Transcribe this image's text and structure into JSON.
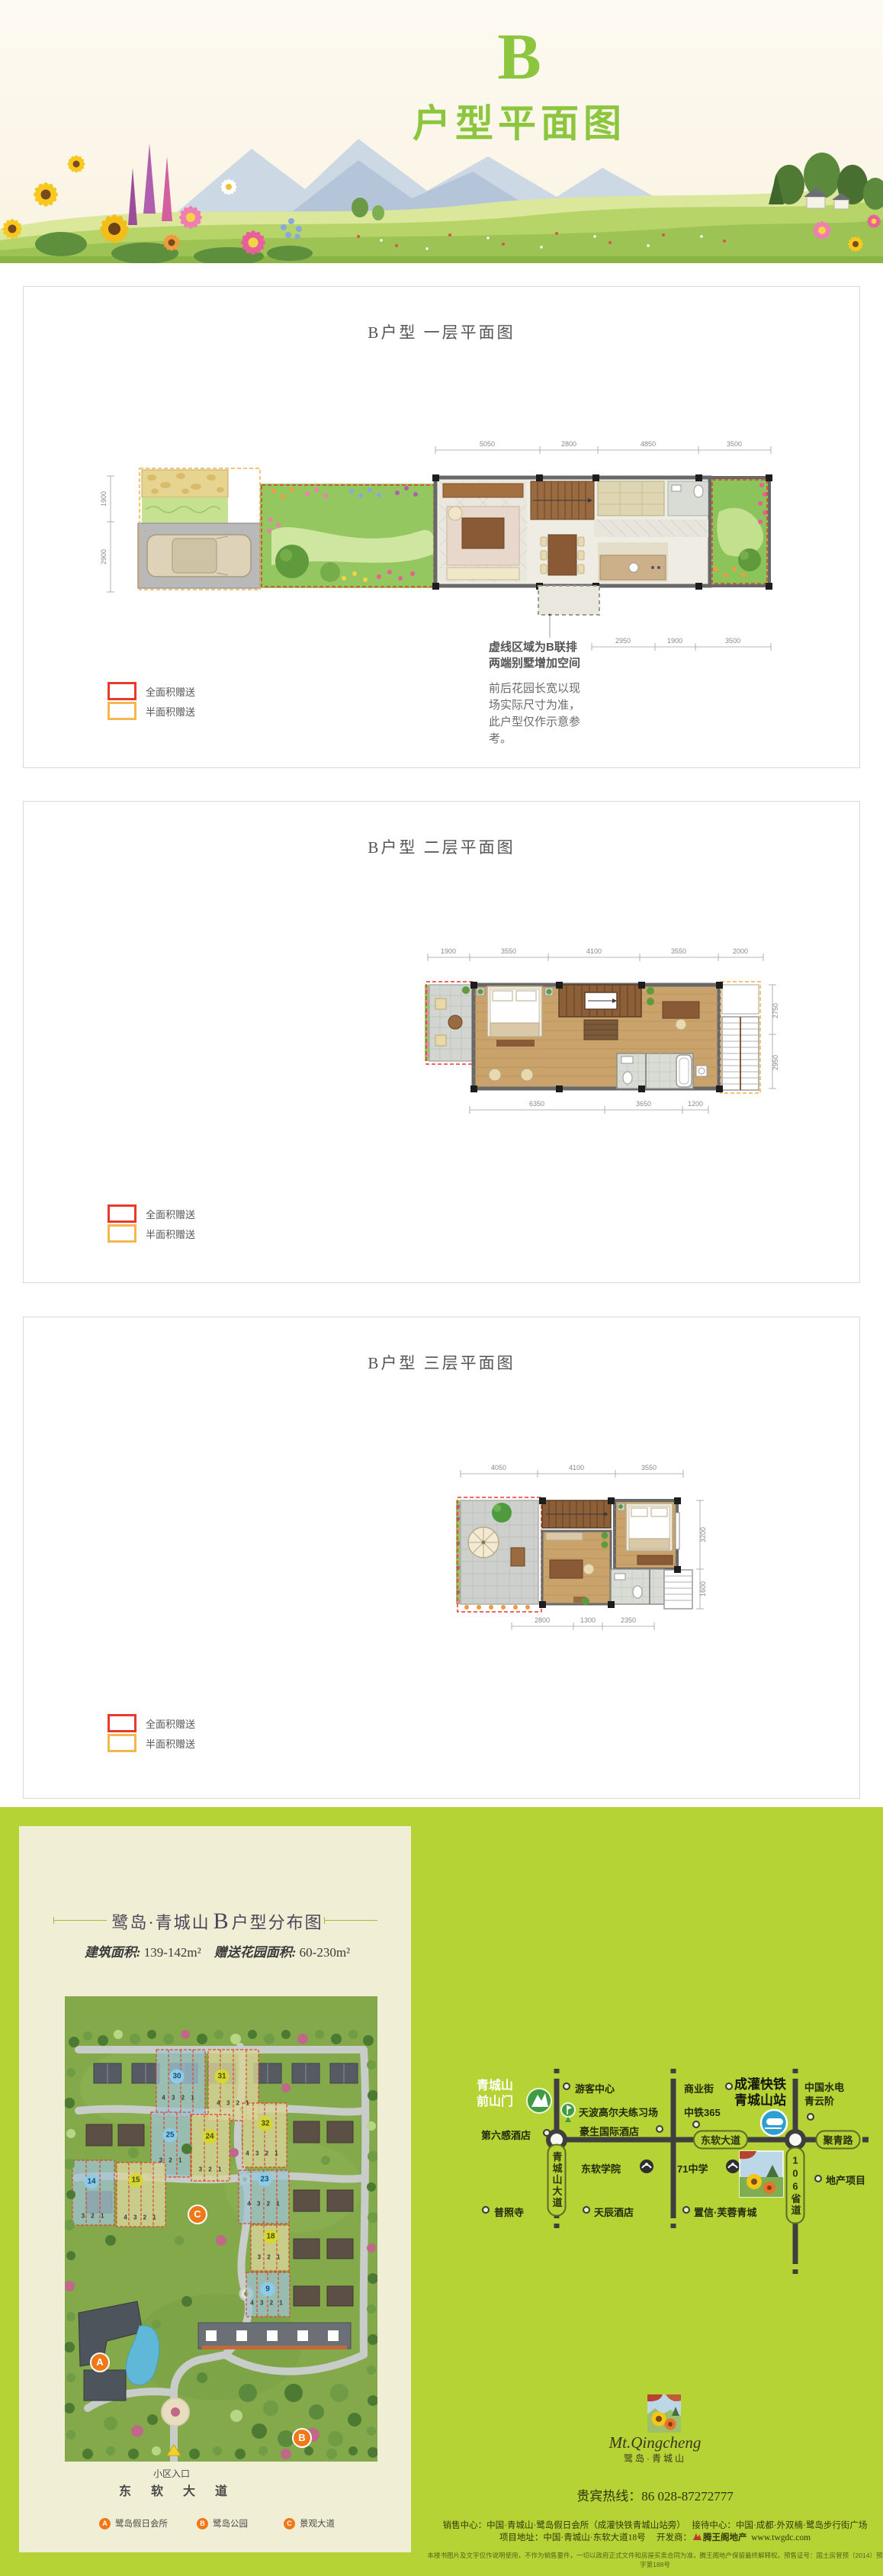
{
  "header": {
    "letter": "B",
    "title": "户型平面图"
  },
  "panel1": {
    "title": "B户型 一层平面图"
  },
  "panel2": {
    "title": "B户型 二层平面图"
  },
  "panel3": {
    "title": "B户型 三层平面图"
  },
  "legend": {
    "full": "全面积赠送",
    "half": "半面积赠送"
  },
  "floor1": {
    "dims_top": [
      "5050",
      "2800",
      "4850",
      "3500"
    ],
    "dims_left": [
      "1900",
      "2900"
    ],
    "dims_bottom": [
      "2950",
      "1900",
      "3500"
    ],
    "note_line1": "虚线区域为B联排",
    "note_line2": "两端别墅增加空间",
    "note_body": "前后花园长宽以现场实际尺寸为准，此户型仅作示意参考。"
  },
  "floor2": {
    "dims_top": [
      "1900",
      "3550",
      "4100",
      "3550",
      "2000"
    ],
    "dims_bottom": [
      "6350",
      "3650",
      "1200"
    ],
    "dims_right": [
      "2750",
      "2950"
    ]
  },
  "floor3": {
    "dims_top": [
      "4050",
      "4100",
      "3550"
    ],
    "dims_bottom": [
      "2800",
      "1300",
      "2350"
    ],
    "dims_right": [
      "3200",
      "1600"
    ]
  },
  "siteplan": {
    "brand": "鹭岛·青城山",
    "unit": "B",
    "title_suffix": "户型分布图",
    "area_label1": "建筑面积:",
    "area_value1": "139-142m²",
    "area_label2": "赠送花园面积:",
    "area_value2": "60-230m²",
    "blocks": [
      {
        "num": "30",
        "units": "4 3 2 1"
      },
      {
        "num": "31",
        "units": "4 3 2 1"
      },
      {
        "num": "25",
        "units": "3 2 1"
      },
      {
        "num": "24",
        "units": "3 2 1"
      },
      {
        "num": "32",
        "units": "4 3 2 1"
      },
      {
        "num": "23",
        "units": "4 3 2 1"
      },
      {
        "num": "14",
        "units": "3 2 1"
      },
      {
        "num": "15",
        "units": "4 3 2 1"
      },
      {
        "num": "18",
        "units": "3 2 1"
      },
      {
        "num": "9",
        "units": "4 3 2 1"
      }
    ],
    "marker_a": "A",
    "marker_b": "B",
    "marker_c": "C",
    "entrance_label": "小区入口",
    "road_label": "东软大道",
    "legend": [
      {
        "key": "A",
        "label": "鹭岛假日会所"
      },
      {
        "key": "B",
        "label": "鹭岛公园"
      },
      {
        "key": "C",
        "label": "景观大道"
      }
    ]
  },
  "map": {
    "gate_line1": "青城山",
    "gate_line2": "前山门",
    "visitor_center": "游客中心",
    "golf": "天波高尔夫练习场",
    "hotel_howard": "豪生国际酒店",
    "hotel_six": "第六感酒店",
    "college": "东软学院",
    "temple": "普照寺",
    "hotel_tianchen": "天辰酒店",
    "biz_street": "商业街",
    "zhongtie": "中铁365",
    "rail_line1": "成灌快铁",
    "rail_line2": "青城山站",
    "hydro_line1": "中国水电",
    "hydro_line2": "青云阶",
    "school71": "71中学",
    "zhixin": "置信·芙蓉青城",
    "project": "地产项目",
    "road_qcs": "青城山大道",
    "road_dr": "东软大道",
    "road_jq": "聚青路",
    "road_106": "106省道"
  },
  "footer": {
    "logo_script": "Mt.Qingcheng",
    "logo_name": "鹭岛·青城山",
    "hotline": "贵宾热线：86 028-87272777",
    "address1": "销售中心：中国·青城山·鹭岛假日会所（成灌快铁青城山站旁）　 接待中心：中国·成都·外双楠·鹭岛步行街广场",
    "address2_prefix": "项目地址：中国·青城山·东软大道18号　 开发商：",
    "developer": "腾王阁地产",
    "website": "www.twgdc.com",
    "disclaimer": "本楼书图片及文字仅作说明使用，不作为销售要件，一切以政府正式文件和房屋买卖合同为准，腾王阁地产保留最终解释权。预售证号：国土房管预（2014）预字第188号"
  }
}
